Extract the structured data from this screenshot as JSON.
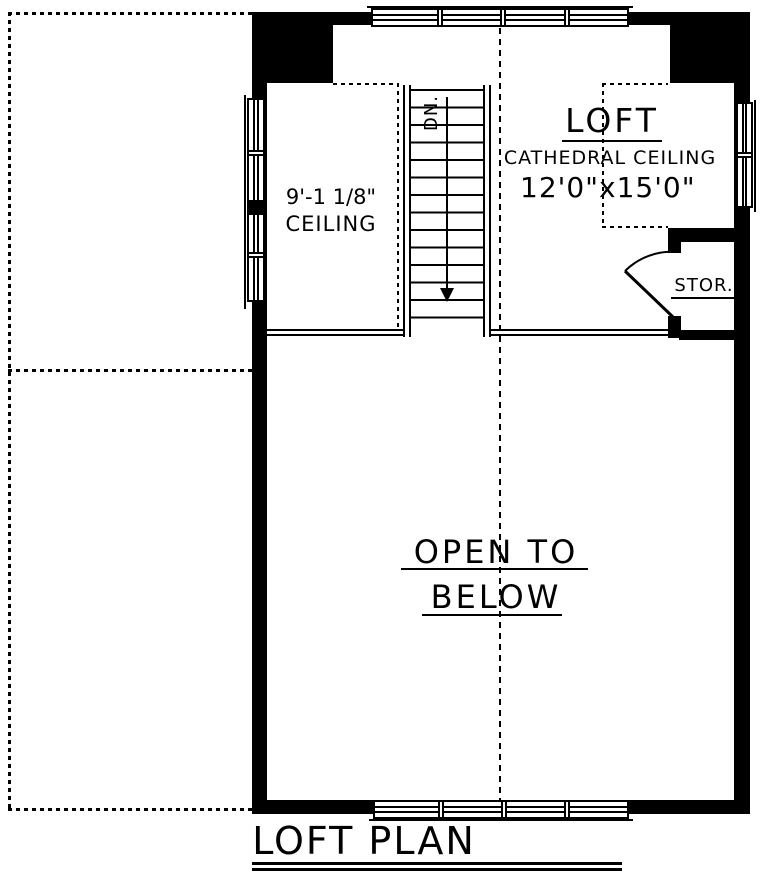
{
  "plan_title": "LOFT PLAN",
  "loft": {
    "name": "LOFT",
    "ceiling": "CATHEDRAL CEILING",
    "size": "12'0\"x15'0\""
  },
  "left_room": {
    "ceiling_height": "9'-1 1/8\"",
    "ceiling_label": "CEILING"
  },
  "storage": {
    "name": "STOR."
  },
  "open_below": {
    "line1": "OPEN TO",
    "line2": "BELOW"
  },
  "stairs": {
    "direction_label": "DN."
  },
  "colors": {
    "ink": "#000000",
    "paper": "#ffffff"
  }
}
